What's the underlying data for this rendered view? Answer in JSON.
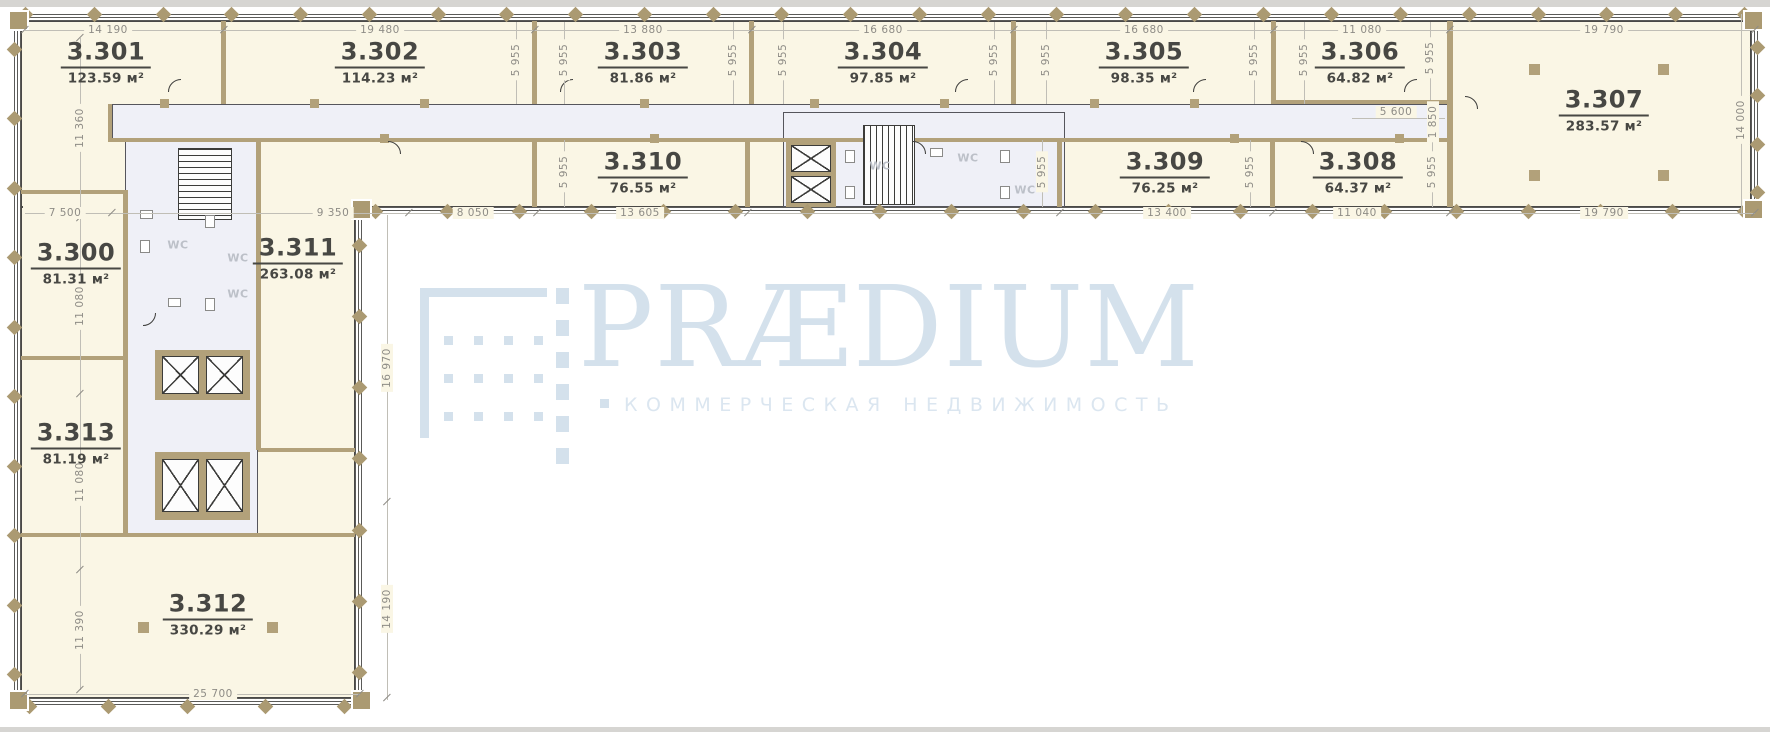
{
  "watermark": {
    "wordmark": "PRÆDIUM",
    "subtitle": "КОММЕРЧЕСКАЯ НЕДВИЖИМОСТЬ"
  },
  "labels": {
    "wc": "WC"
  },
  "rooms": {
    "r301": {
      "number": "3.301",
      "area": "123.59 м²"
    },
    "r302": {
      "number": "3.302",
      "area": "114.23 м²"
    },
    "r303": {
      "number": "3.303",
      "area": "81.86 м²"
    },
    "r304": {
      "number": "3.304",
      "area": "97.85 м²"
    },
    "r305": {
      "number": "3.305",
      "area": "98.35 м²"
    },
    "r306": {
      "number": "3.306",
      "area": "64.82 м²"
    },
    "r307": {
      "number": "3.307",
      "area": "283.57 м²"
    },
    "r308": {
      "number": "3.308",
      "area": "64.37 м²"
    },
    "r309": {
      "number": "3.309",
      "area": "76.25 м²"
    },
    "r310": {
      "number": "3.310",
      "area": "76.55 м²"
    },
    "r300": {
      "number": "3.300",
      "area": "81.31 м²"
    },
    "r311": {
      "number": "3.311",
      "area": "263.08 м²"
    },
    "r312": {
      "number": "3.312",
      "area": "330.29 м²"
    },
    "r313": {
      "number": "3.313",
      "area": "81.19 м²"
    }
  },
  "dimensions": {
    "top": [
      "14 190",
      "19 480",
      "13 880",
      "16 680",
      "16 680",
      "11 080",
      "19 790"
    ],
    "left": [
      "11 360",
      "11 080",
      "11 080",
      "11 390"
    ],
    "inner_row": [
      "7 500",
      "9 350",
      "8 050",
      "13 605",
      "13 400",
      "11 040",
      "19 790"
    ],
    "right_wing": [
      "16 970",
      "14 190"
    ],
    "right_top": "14 000",
    "bottom": "25 700",
    "depth": "5 955",
    "passage": "5 600",
    "passage_depth": "1 850"
  },
  "colors": {
    "wall": "#b2a17a",
    "room_fill": "#faf6e5",
    "core_fill": "#eff0f7",
    "logo": "#d4e1ec"
  }
}
